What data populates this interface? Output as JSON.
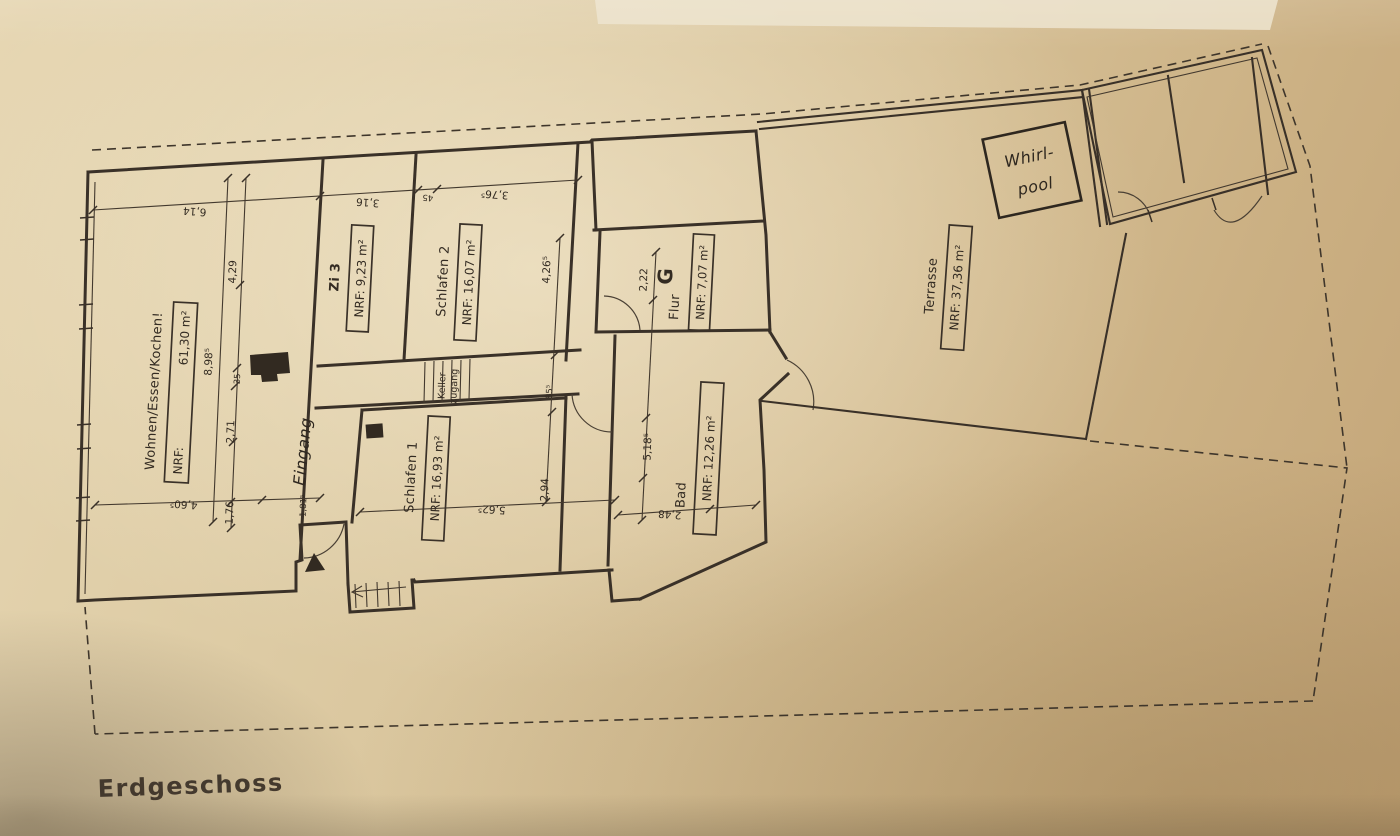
{
  "page": {
    "title": "Erdgeschoss"
  },
  "rooms": {
    "wohnen": {
      "name": "Wohnen/Essen/Kochen!",
      "nrf_label": "NRF:",
      "nrf_value": "61,30 m²"
    },
    "zi3": {
      "name": "Zi 3",
      "nrf": "NRF: 9,23 m²"
    },
    "schlafen2": {
      "name": "Schlafen 2",
      "nrf": "NRF: 16,07 m²"
    },
    "schlafen1": {
      "name": "Schlafen 1",
      "nrf": "NRF: 16,93 m²"
    },
    "bad": {
      "name": "Bad",
      "nrf": "NRF: 12,26 m²"
    },
    "flur": {
      "name": "Flur",
      "letter": "G",
      "nrf": "NRF: 7,07 m²"
    },
    "terrasse": {
      "name": "Terrasse",
      "nrf": "NRF: 37,36 m²"
    }
  },
  "annotations": {
    "whirlpool_line1": "Whirl-",
    "whirlpool_line2": "pool",
    "eingang": "Eingang",
    "keller_line1": "Keller",
    "keller_line2": "zugang"
  },
  "dims": {
    "v614": "6,14",
    "v429": "4,29",
    "v898": "8,98⁵",
    "v35": "35",
    "v271": "2,71",
    "v176": "1,76",
    "v460": "4,60⁵",
    "v181": "1,81⁵",
    "v316": "3,16",
    "v45": "45",
    "v376": "3,76⁵",
    "v426": "4,26⁵",
    "v222": "2,22",
    "v85": "85⁵",
    "v518": "5,18⁵",
    "v294": "2,94",
    "v562": "5,62⁵",
    "v248": "2,48"
  },
  "colors": {
    "ink": "#3a3128",
    "paper": "#d6c096"
  }
}
